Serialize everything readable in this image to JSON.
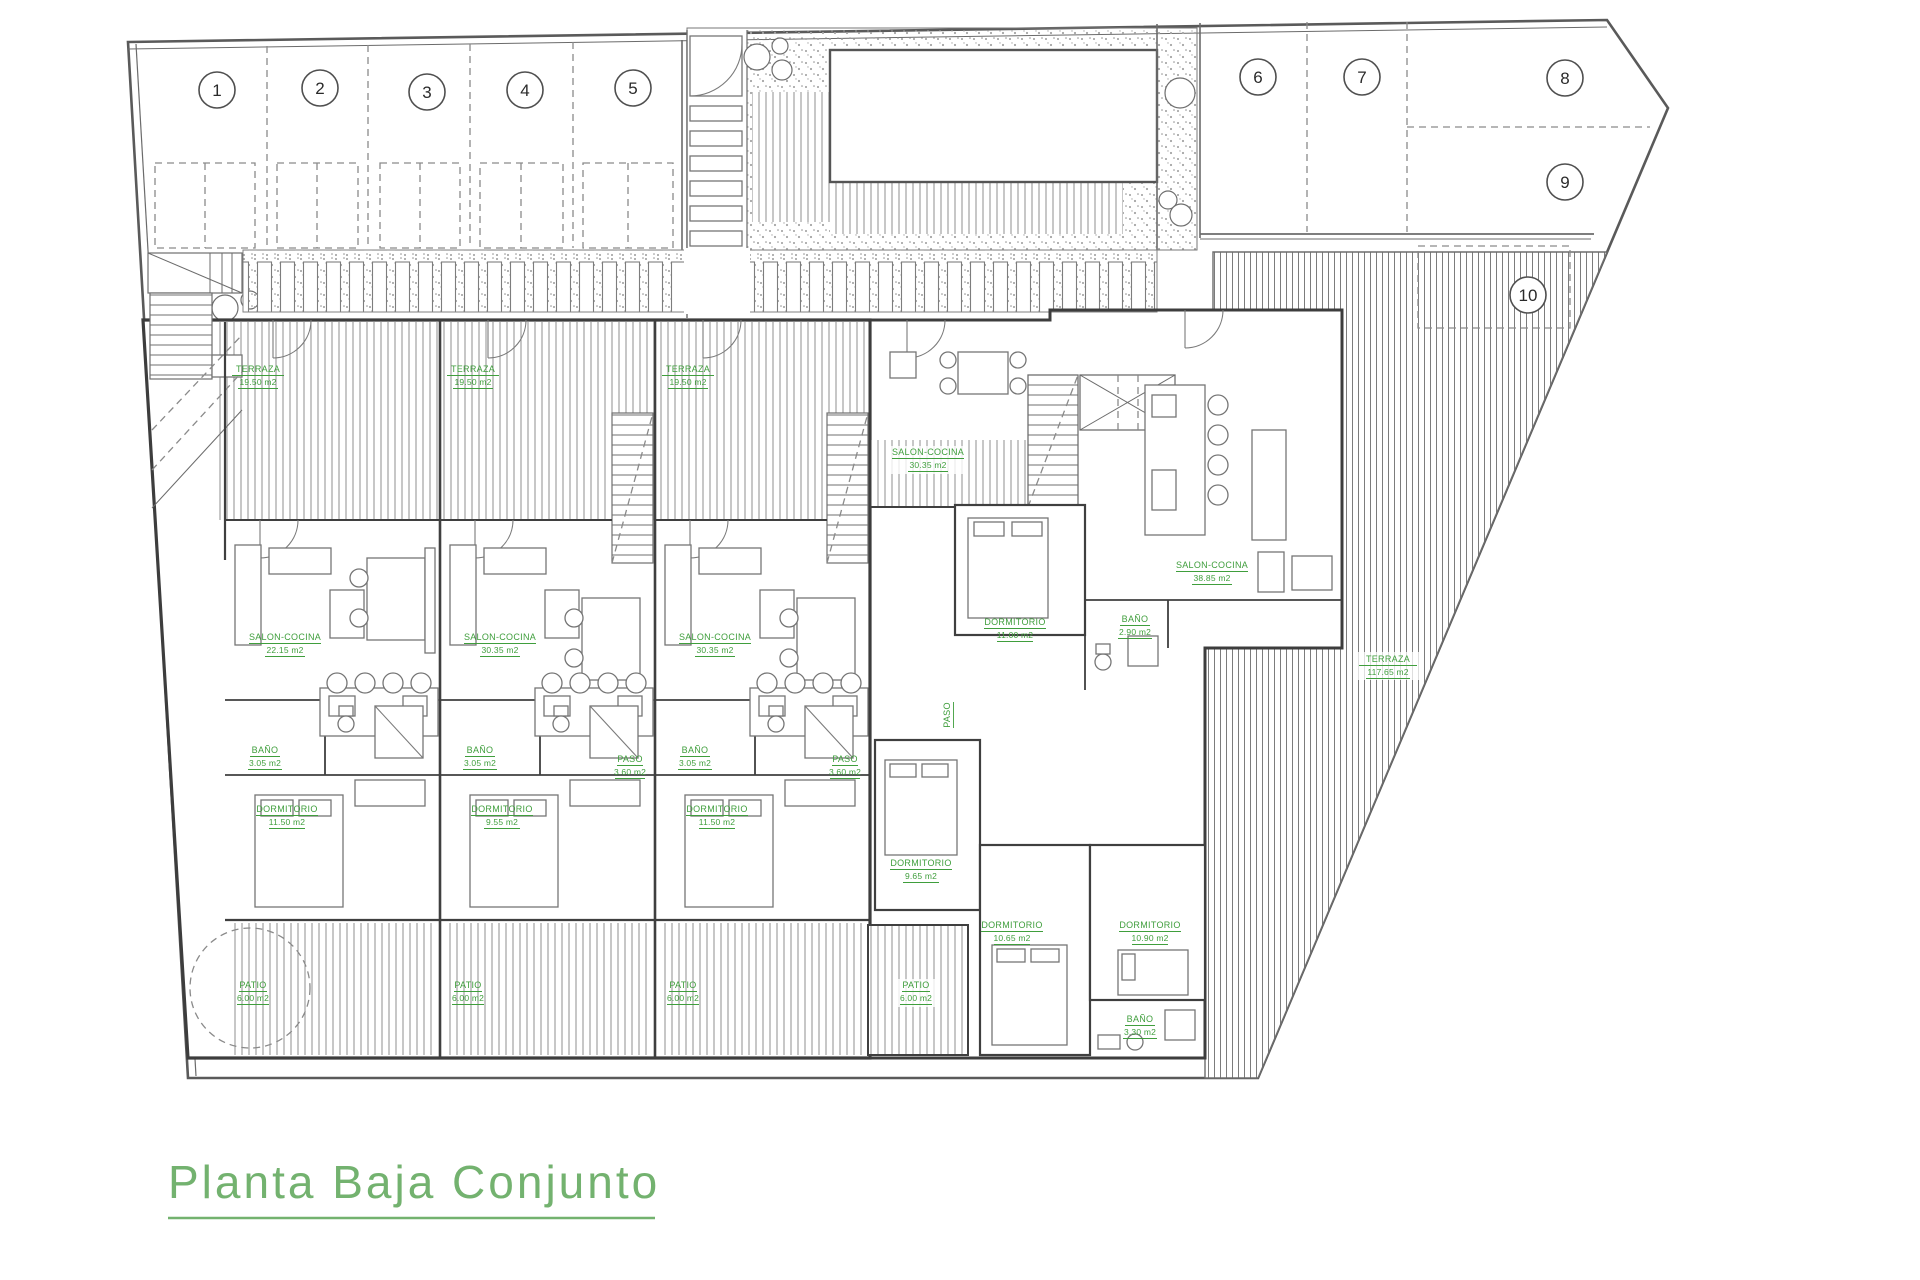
{
  "title": {
    "text": "Planta Baja Conjunto"
  },
  "parking": {
    "spaces": [
      "1",
      "2",
      "3",
      "4",
      "5",
      "6",
      "7",
      "8",
      "9",
      "10"
    ]
  },
  "rooms": {
    "terraza": {
      "name": "TERRAZA",
      "area": "19.50 m2"
    },
    "terraza_big": {
      "name": "TERRAZA",
      "area": "117.65 m2"
    },
    "salon_a": {
      "name": "SALON-COCINA",
      "area": "22.15 m2"
    },
    "salon_b": {
      "name": "SALON-COCINA",
      "area": "30.35 m2"
    },
    "salon_big": {
      "name": "SALON-COCINA",
      "area": "38.85 m2"
    },
    "bano_a": {
      "name": "BAÑO",
      "area": "3.05 m2"
    },
    "bano_b": {
      "name": "BAÑO",
      "area": "2.90 m2"
    },
    "bano_c": {
      "name": "BAÑO",
      "area": "3.30 m2"
    },
    "paso": {
      "name": "PASO",
      "area": "3.60 m2"
    },
    "dorm_a": {
      "name": "DORMITORIO",
      "area": "11.50 m2"
    },
    "dorm_b": {
      "name": "DORMITORIO",
      "area": "9.55 m2"
    },
    "dorm_d": {
      "name": "DORMITORIO",
      "area": "11.00 m2"
    },
    "dorm_e": {
      "name": "DORMITORIO",
      "area": "9.65 m2"
    },
    "dorm_f": {
      "name": "DORMITORIO",
      "area": "10.65 m2"
    },
    "dorm_g": {
      "name": "DORMITORIO",
      "area": "10.90 m2"
    },
    "patio": {
      "name": "PATIO",
      "area": "6.00 m2"
    }
  },
  "colors": {
    "label_green": "#3f9e3c",
    "title_green": "#73b26f"
  }
}
